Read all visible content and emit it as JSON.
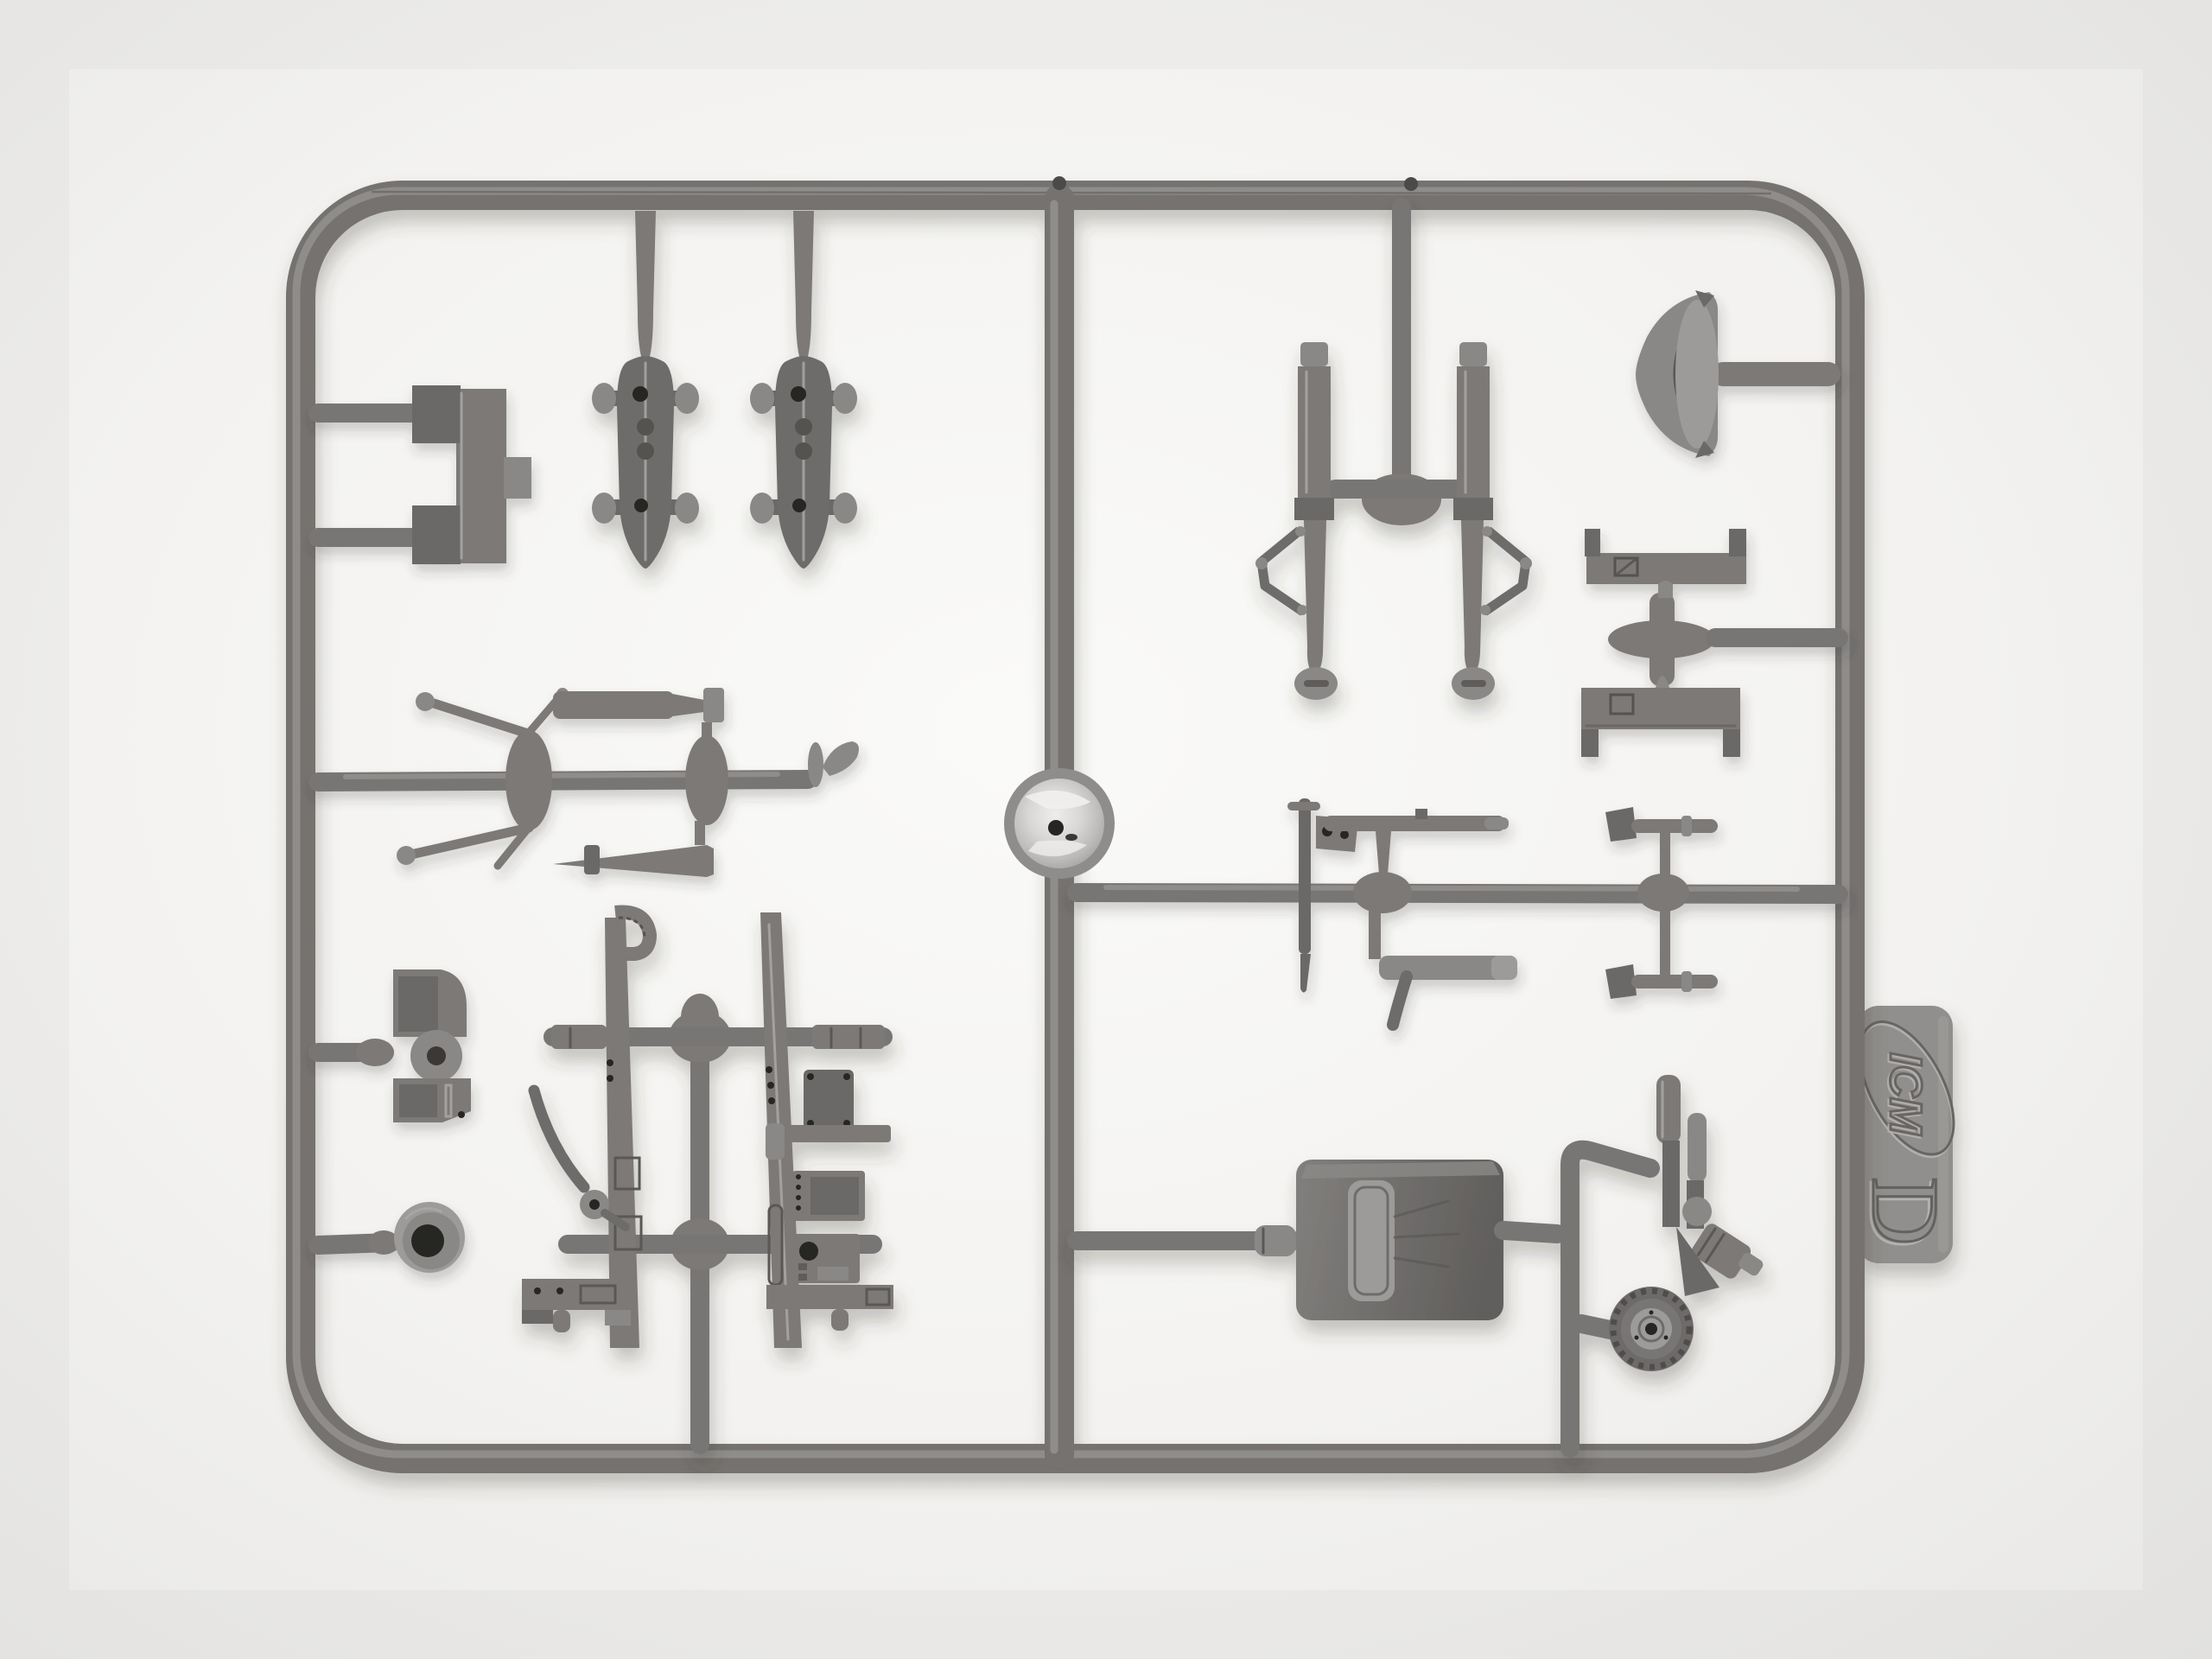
{
  "meta": {
    "kind": "photograph",
    "subject": "Gray injection-molded styrene model kit sprue (runner frame) with aircraft detail parts, photographed on a white seamless background",
    "orientation": "landscape"
  },
  "palette": {
    "background": "#f3f2f0",
    "background_edge": "#e9e8e6",
    "plastic_base": "#7a7876",
    "plastic_light": "#a8a6a4",
    "plastic_dark": "#5e5c5a",
    "gate_hub_bright": "#dcdbd9",
    "hole_dark": "#262524",
    "shadow": "#3a3836"
  },
  "sprue": {
    "brand_logo": "ICM",
    "frame_letter": "D",
    "material": "gray styrene plastic",
    "tab_position": "right edge, rotated 90 degrees"
  },
  "parts": [
    {
      "id": "frame",
      "label": "Rectangular sprue frame with rounded corners"
    },
    {
      "id": "center-rail",
      "label": "Central vertical runner"
    },
    {
      "id": "gate-hub",
      "label": "Bright injection gate hub on central runner"
    },
    {
      "id": "u-bracket",
      "label": "U-shaped mount bracket (top left)"
    },
    {
      "id": "float-left",
      "label": "Small bomb / float body with lugs (left of pair)"
    },
    {
      "id": "float-right",
      "label": "Small bomb / float body with lugs (right of pair)"
    },
    {
      "id": "strut-left",
      "label": "Landing gear oleo strut with scissor link (left)"
    },
    {
      "id": "strut-right",
      "label": "Landing gear oleo strut with scissor link (right)"
    },
    {
      "id": "fairing-crescent",
      "label": "Crescent wheel-spat fairing half (top right)"
    },
    {
      "id": "channel-upper",
      "label": "Channel bulkhead bracket (upper)"
    },
    {
      "id": "channel-lower",
      "label": "Channel bulkhead bracket (lower)"
    },
    {
      "id": "control-column",
      "label": "Control column with mount bracket"
    },
    {
      "id": "machine-gun",
      "label": "Machine gun barrel part"
    },
    {
      "id": "exhaust-l",
      "label": "L-shaped exhaust pipe"
    },
    {
      "id": "pitot-upper",
      "label": "Small gun / pitot rod (upper right pair)"
    },
    {
      "id": "pitot-lower",
      "label": "Small gun / pitot rod (lower right pair)"
    },
    {
      "id": "stick-upper",
      "label": "Cranked control stick with ball grip (upper)"
    },
    {
      "id": "stick-lower",
      "label": "Cranked control stick with ball grip (lower)"
    },
    {
      "id": "actuator-blade",
      "label": "Flat actuating rod / blade"
    },
    {
      "id": "cone-fairing",
      "label": "Tapered cone part"
    },
    {
      "id": "hook-tip",
      "label": "Small curved hook part at runner end"
    },
    {
      "id": "gun-mount-bracket",
      "label": "Gun mount bracket with pivot boss (left)"
    },
    {
      "id": "grommet-ring",
      "label": "Ring grommet with dark center hole (left)"
    },
    {
      "id": "cockpit-frame-left",
      "label": "Cockpit sidewall frame with fittings (left)"
    },
    {
      "id": "cockpit-frame-right",
      "label": "Cockpit sidewall frame with equipment boxes (right)"
    },
    {
      "id": "curved-lever",
      "label": "Curved control lever with pivot disc"
    },
    {
      "id": "seat-box",
      "label": "Pilot seat / headrest box with cushion"
    },
    {
      "id": "tail-strut-assembly",
      "label": "Tail wheel strut assembly with cylinders"
    },
    {
      "id": "tail-wheel",
      "label": "Tail wheel with ribbed tire and hub"
    },
    {
      "id": "logo-tab",
      "label": "Embossed ICM logo tab with frame letter D"
    }
  ]
}
